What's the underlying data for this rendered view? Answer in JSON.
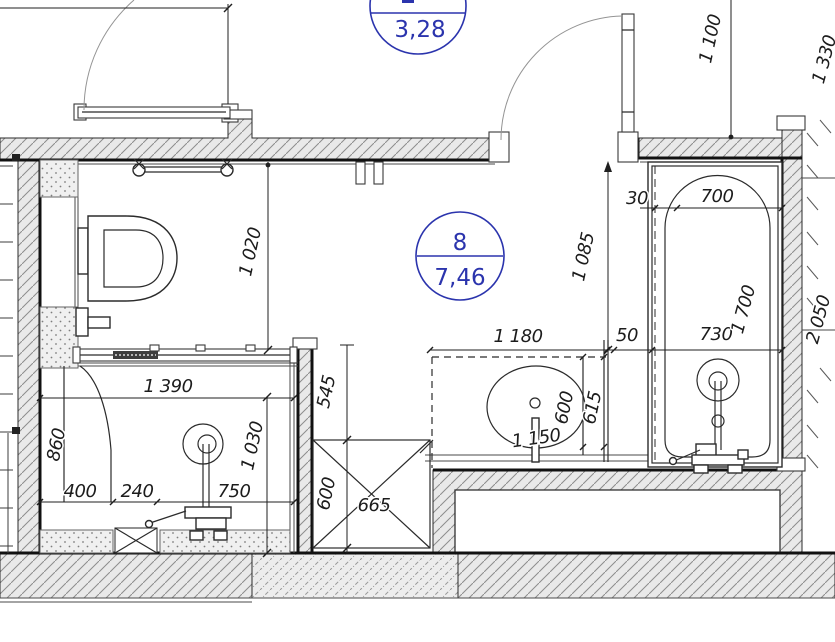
{
  "labels": {
    "main_room": {
      "number": "8",
      "area": "7,46"
    },
    "top_room": {
      "area": "3,28"
    }
  },
  "dims": {
    "d1390": "1 390",
    "d860": "860",
    "d400": "400",
    "d240": "240",
    "d750": "750",
    "d1030": "1 030",
    "d1020": "1 020",
    "d545": "545",
    "d600_niche": "600",
    "d665": "665",
    "d1180": "1 180",
    "d50": "50",
    "d730": "730",
    "d30": "30",
    "d700": "700",
    "d1085": "1 085",
    "d600_sink": "600",
    "d615": "615",
    "d1150": "1 150",
    "d1700": "1 700",
    "d1100": "1 100",
    "d1330": "1 330",
    "d2050": "2 050"
  },
  "colors": {
    "label_blue": "#2b34ad",
    "wall_fill": "#e9e9e9",
    "line": "#222222"
  }
}
